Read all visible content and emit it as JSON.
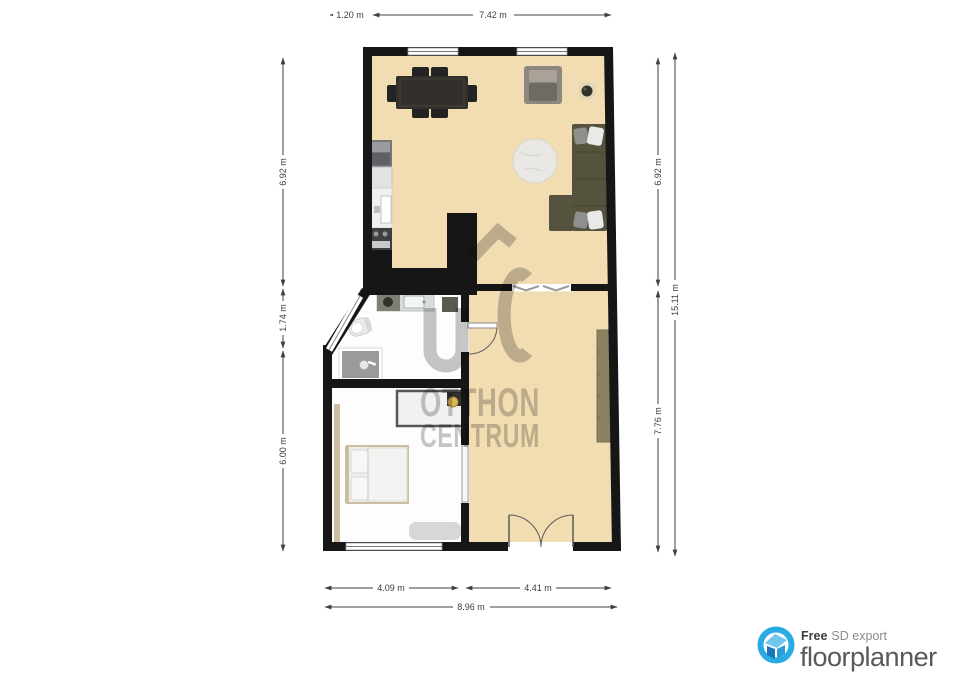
{
  "dimensions": {
    "top": [
      "1.20 m",
      "7.42 m"
    ],
    "left": [
      "6.92 m",
      "1.74 m",
      "6.00 m"
    ],
    "right_inner": [
      "6.92 m",
      "7.76 m"
    ],
    "right_outer": "15.11 m",
    "bottom": [
      "4.09 m",
      "4.41 m"
    ],
    "bottom_total": "8.96 m"
  },
  "watermark": {
    "line1": "OTTHON",
    "line2": "CENTRUM",
    "color": "#c6c6c6"
  },
  "branding": {
    "free_label": "Free",
    "export_label": "SD export",
    "brand_name": "floorplanner",
    "accent_color": "#29abe2",
    "brand_text_color": "#58595b"
  },
  "colors": {
    "floor_tan": "#f2dcb2",
    "floor_white": "#fdfdfd",
    "wall_black": "#161616",
    "sofa_olive": "#55523e",
    "dimension_text": "#3c3c3c"
  }
}
